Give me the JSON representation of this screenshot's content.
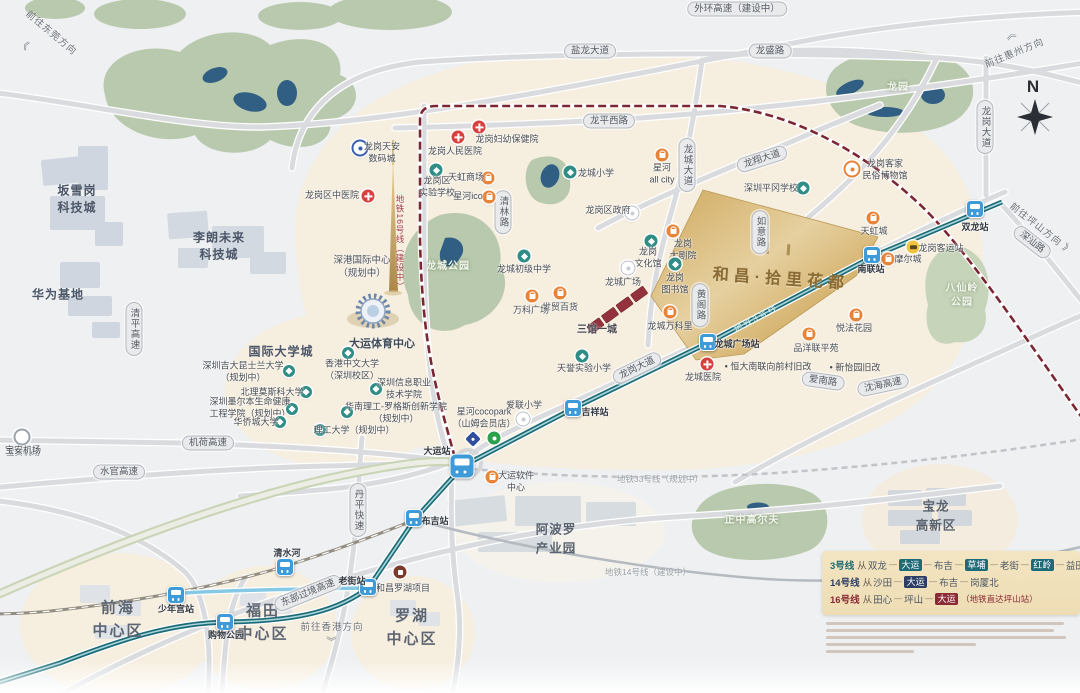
{
  "property": {
    "name": "和昌·拾里花都"
  },
  "compass": {
    "label": "N"
  },
  "colors": {
    "line3": "#1d6b77",
    "line3_core": "#a9d6db",
    "line10": "#86c9e6",
    "line16": "#7a2733",
    "line14": "#b5bac0",
    "line33": "#c0c4c9",
    "road": "#d9dbde",
    "highway_edge": "#c9d4b4",
    "beige": "#f6eedf",
    "park": "#b9c9ad",
    "lake": "#315f83",
    "gold": "#d4b06a",
    "hospital": "#d84040",
    "school": "#2f8d85",
    "shop": "#e8833a",
    "station": "#3f9bd8"
  },
  "legend": {
    "lines": [
      {
        "name": "3号线",
        "color": "#1d6b77",
        "from": "从",
        "start": "双龙",
        "stops": [
          {
            "t": "大运",
            "box": true
          },
          {
            "t": "布吉"
          },
          {
            "t": "草埔",
            "box": true
          },
          {
            "t": "老街"
          },
          {
            "t": "红岭",
            "box": true
          },
          {
            "t": "益田"
          }
        ],
        "suffix": ""
      },
      {
        "name": "14号线",
        "color": "#2c3e66",
        "from": "从",
        "start": "沙田",
        "stops": [
          {
            "t": "大运",
            "box": true
          },
          {
            "t": "布吉"
          },
          {
            "t": "岗厦北"
          }
        ],
        "suffix": ""
      },
      {
        "name": "16号线",
        "color": "#8a2a35",
        "from": "从",
        "start": "田心",
        "stops": [
          {
            "t": "坪山"
          },
          {
            "t": "大运",
            "box": true
          }
        ],
        "suffix": "（地铁直达坪山站）"
      }
    ]
  },
  "capsules": [
    {
      "t": "外环高速（建设中）",
      "x": 737,
      "y": 9
    },
    {
      "t": "盐龙大道",
      "x": 590,
      "y": 51
    },
    {
      "t": "龙盛路",
      "x": 770,
      "y": 51
    },
    {
      "t": "龙平西路",
      "x": 609,
      "y": 121
    },
    {
      "t": "龙翔大道",
      "x": 762,
      "y": 159,
      "rot": -18
    },
    {
      "t": "龙城大道",
      "x": 687,
      "y": 165,
      "vert": true
    },
    {
      "t": "龙岗大道",
      "x": 985,
      "y": 127,
      "vert": true
    },
    {
      "t": "龙岗大道",
      "x": 637,
      "y": 368,
      "rot": -26
    },
    {
      "t": "深汕路",
      "x": 1032,
      "y": 242,
      "rot": 38
    },
    {
      "t": "沈海高速",
      "x": 883,
      "y": 385,
      "rot": -12
    },
    {
      "t": "爱南路",
      "x": 823,
      "y": 381,
      "rot": 8
    },
    {
      "t": "清林路",
      "x": 503,
      "y": 212,
      "vert": true
    },
    {
      "t": "黄阁路",
      "x": 700,
      "y": 305,
      "vert": true
    },
    {
      "t": "如意路",
      "x": 760,
      "y": 232,
      "vert": true
    },
    {
      "t": "清平高速",
      "x": 134,
      "y": 329,
      "vert": true
    },
    {
      "t": "水官高速",
      "x": 119,
      "y": 472
    },
    {
      "t": "机荷高速",
      "x": 208,
      "y": 443
    },
    {
      "t": "丹平快速",
      "x": 358,
      "y": 510,
      "vert": true
    },
    {
      "t": "东部过境高速",
      "x": 308,
      "y": 593,
      "rot": -22
    }
  ],
  "stations": [
    {
      "name": "双龙站",
      "x": 975,
      "y": 209,
      "lx": 975,
      "ly": 228
    },
    {
      "name": "南联站",
      "x": 872,
      "y": 255,
      "lx": 871,
      "ly": 270
    },
    {
      "name": "龙城广场站",
      "x": 708,
      "y": 342,
      "lx": 737,
      "ly": 345
    },
    {
      "name": "吉祥站",
      "x": 573,
      "y": 408,
      "lx": 595,
      "ly": 413
    },
    {
      "name": "大运站",
      "x": 462,
      "y": 466,
      "lx": 437,
      "ly": 452,
      "big": true
    },
    {
      "name": "布吉站",
      "x": 414,
      "y": 518,
      "lx": 435,
      "ly": 522
    },
    {
      "name": "老街站",
      "x": 368,
      "y": 587,
      "lx": 352,
      "ly": 582
    },
    {
      "name": "清水河",
      "x": 285,
      "y": 567,
      "lx": 287,
      "ly": 554
    },
    {
      "name": "少年宫站",
      "x": 176,
      "y": 595,
      "lx": 176,
      "ly": 610
    },
    {
      "name": "购物公园",
      "x": 225,
      "y": 622,
      "lx": 226,
      "ly": 636
    }
  ],
  "pois": [
    {
      "type": "tianan",
      "x": 360,
      "y": 148,
      "label": "龙岗天安\n数码城",
      "lx": 382,
      "ly": 153
    },
    {
      "type": "hospital",
      "x": 368,
      "y": 196,
      "label": "龙岗区中医院",
      "lx": 332,
      "ly": 196
    },
    {
      "type": "hospital",
      "x": 458,
      "y": 137,
      "label": "龙岗人民医院",
      "lx": 455,
      "ly": 152
    },
    {
      "type": "hospital",
      "x": 479,
      "y": 127,
      "label": "龙岗妇幼保健院",
      "lx": 507,
      "ly": 140
    },
    {
      "type": "school",
      "x": 436,
      "y": 170,
      "label": "龙岗区\n实验学校",
      "lx": 437,
      "ly": 187
    },
    {
      "type": "shop",
      "x": 488,
      "y": 178,
      "label": "天虹商场",
      "lx": 466,
      "ly": 178
    },
    {
      "type": "shop",
      "x": 489,
      "y": 197,
      "label": "星河ico",
      "lx": 468,
      "ly": 197
    },
    {
      "type": "school",
      "x": 570,
      "y": 172,
      "label": "龙城小学",
      "lx": 596,
      "ly": 174
    },
    {
      "type": "shop",
      "x": 662,
      "y": 155,
      "label": "星河\nall city",
      "lx": 662,
      "ly": 174
    },
    {
      "type": "gov",
      "x": 632,
      "y": 213,
      "label": "龙岗区政府",
      "lx": 608,
      "ly": 211
    },
    {
      "type": "school",
      "x": 524,
      "y": 256,
      "label": "龙城初级中学",
      "lx": 524,
      "ly": 270
    },
    {
      "type": "theater",
      "x": 673,
      "y": 231,
      "label": "龙岗\n大剧院",
      "lx": 683,
      "ly": 250
    },
    {
      "type": "culture",
      "x": 651,
      "y": 241,
      "label": "龙岗\n文化馆",
      "lx": 648,
      "ly": 258
    },
    {
      "type": "gov",
      "x": 628,
      "y": 268,
      "label": "龙城广场",
      "lx": 623,
      "ly": 283
    },
    {
      "type": "culture",
      "x": 675,
      "y": 264,
      "label": "龙岗\n图书馆",
      "lx": 675,
      "ly": 284
    },
    {
      "type": "museum",
      "x": 852,
      "y": 169,
      "label": "龙岗客家\n民俗博物馆",
      "lx": 885,
      "ly": 170
    },
    {
      "type": "school",
      "x": 803,
      "y": 188,
      "label": "深圳平冈学校",
      "lx": 771,
      "ly": 189
    },
    {
      "type": "shop",
      "x": 560,
      "y": 293,
      "label": "世贸百货",
      "lx": 560,
      "ly": 308
    },
    {
      "type": "shop",
      "x": 532,
      "y": 296,
      "label": "万科广场",
      "lx": 531,
      "ly": 311
    },
    {
      "type": "shop",
      "x": 670,
      "y": 312,
      "label": "龙城万科里",
      "lx": 670,
      "ly": 327
    },
    {
      "type": "school",
      "x": 582,
      "y": 356,
      "label": "天誉实验小学",
      "lx": 584,
      "ly": 369
    },
    {
      "type": "hospital",
      "x": 707,
      "y": 364,
      "label": "龙城医院",
      "lx": 703,
      "ly": 378
    },
    {
      "type": "shop",
      "x": 809,
      "y": 334,
      "label": "品洋联平苑",
      "lx": 816,
      "ly": 349
    },
    {
      "type": "shop",
      "x": 856,
      "y": 315,
      "label": "悦法花园",
      "lx": 854,
      "ly": 329
    },
    {
      "type": "shop",
      "x": 873,
      "y": 218,
      "label": "天虹城",
      "lx": 874,
      "ly": 232
    },
    {
      "type": "shop",
      "x": 888,
      "y": 259,
      "label": "摩尔城",
      "lx": 908,
      "ly": 260
    },
    {
      "type": "bus",
      "x": 913,
      "y": 247,
      "label": "龙岗客运站",
      "lx": 941,
      "ly": 249
    },
    {
      "type": "univ",
      "x": 348,
      "y": 353,
      "label": "香港中文大学\n（深圳校区）",
      "lx": 352,
      "ly": 370
    },
    {
      "type": "univ",
      "x": 289,
      "y": 371,
      "label": "深圳吉大昆士兰大学\n（规划中）",
      "lx": 243,
      "ly": 372
    },
    {
      "type": "univ",
      "x": 306,
      "y": 392,
      "label": "北理莫斯科大学",
      "lx": 272,
      "ly": 393
    },
    {
      "type": "univ",
      "x": 376,
      "y": 389,
      "label": "深圳信息职业\n技术学院",
      "lx": 404,
      "ly": 389
    },
    {
      "type": "univ",
      "x": 292,
      "y": 409,
      "label": "深圳墨尔本生命健康\n工程学院（规划中）",
      "lx": 250,
      "ly": 408
    },
    {
      "type": "univ",
      "x": 347,
      "y": 412,
      "label": "华南理工-罗格斯创新学院\n（规划中）",
      "lx": 396,
      "ly": 413
    },
    {
      "type": "univ",
      "x": 280,
      "y": 422,
      "label": "华侨城大学",
      "lx": 256,
      "ly": 423
    },
    {
      "type": "univ",
      "x": 320,
      "y": 430,
      "label": "理工大学（规划中）",
      "lx": 354,
      "ly": 431
    },
    {
      "type": "gov",
      "x": 523,
      "y": 419,
      "label": "爱联小学",
      "lx": 524,
      "ly": 406
    },
    {
      "type": "mallblue",
      "x": 473,
      "y": 439,
      "label": "星河cocopark\n（山姆会员店）",
      "lx": 484,
      "ly": 418
    },
    {
      "type": "cocogreen",
      "x": 494,
      "y": 438,
      "label": "",
      "lx": 494,
      "ly": 438
    },
    {
      "type": "shop",
      "x": 492,
      "y": 477,
      "label": "大运软件\n中心",
      "lx": 516,
      "ly": 482
    },
    {
      "type": "brand",
      "x": 400,
      "y": 572,
      "label": "和昌罗湖项目",
      "lx": 403,
      "ly": 589
    },
    {
      "type": "ringgray",
      "x": 22,
      "y": 437,
      "label": "宝安机场",
      "lx": 23,
      "ly": 451
    }
  ],
  "texts": [
    {
      "t": "坂雪岗\n科技城",
      "x": 77,
      "y": 200,
      "cls": "district"
    },
    {
      "t": "华为基地",
      "x": 58,
      "y": 295,
      "cls": "district"
    },
    {
      "t": "李朗未来\n科技城",
      "x": 219,
      "y": 247,
      "cls": "district"
    },
    {
      "t": "国际大学城",
      "x": 281,
      "y": 352,
      "cls": "district"
    },
    {
      "t": "前海\n中心区",
      "x": 118,
      "y": 620,
      "cls": "district-lg"
    },
    {
      "t": "福田\n中心区",
      "x": 263,
      "y": 623,
      "cls": "district-lg"
    },
    {
      "t": "罗湖\n中心区",
      "x": 412,
      "y": 628,
      "cls": "district-lg"
    },
    {
      "t": "阿波罗\n产业园",
      "x": 556,
      "y": 539,
      "cls": "district-md"
    },
    {
      "t": "宝龙\n高新区",
      "x": 936,
      "y": 516,
      "cls": "district-md"
    },
    {
      "t": "龙城公园",
      "x": 448,
      "y": 267,
      "cls": "park"
    },
    {
      "t": "龙园",
      "x": 898,
      "y": 88,
      "cls": "park"
    },
    {
      "t": "八仙岭\n公园",
      "x": 962,
      "y": 296,
      "cls": "park"
    },
    {
      "t": "正中高尔夫",
      "x": 752,
      "y": 521,
      "cls": "park"
    },
    {
      "t": "深港国际中心\n（规划中）",
      "x": 362,
      "y": 268,
      "cls": "poi-dark"
    },
    {
      "t": "大运体育中心",
      "x": 382,
      "y": 343,
      "cls": "bold-dark"
    },
    {
      "t": "三馆一城",
      "x": 597,
      "y": 328,
      "cls": "bold-dark2"
    },
    {
      "t": "地铁16号线（建设中）",
      "x": 400,
      "y": 243,
      "cls": "metro-red-vert"
    },
    {
      "t": "地铁3号线",
      "x": 756,
      "y": 318,
      "cls": "metro-teal",
      "rot": -28
    },
    {
      "t": "地铁33号线（规划中）",
      "x": 660,
      "y": 479,
      "cls": "metro-gray"
    },
    {
      "t": "地铁14号线（建设中）",
      "x": 648,
      "y": 572,
      "cls": "metro-gray"
    },
    {
      "t": "• 恒大南联向前村旧改",
      "x": 768,
      "y": 366,
      "cls": "bullet"
    },
    {
      "t": "• 新怡园旧改",
      "x": 855,
      "y": 367,
      "cls": "bullet"
    },
    {
      "t": "前往惠州方向",
      "x": 1014,
      "y": 52,
      "cls": "dir",
      "rot": -22
    },
    {
      "t": "《",
      "x": 1011,
      "y": 34,
      "cls": "dir-arrow",
      "rot": 65
    },
    {
      "t": "前往坪山方向 》",
      "x": 1042,
      "y": 228,
      "cls": "dir",
      "rot": 38
    },
    {
      "t": "前往东莞方向",
      "x": 52,
      "y": 32,
      "cls": "dir",
      "rot": 40
    },
    {
      "t": "《",
      "x": 24,
      "y": 44,
      "cls": "dir-arrow",
      "rot": 25
    },
    {
      "t": "前往香港方向",
      "x": 332,
      "y": 626,
      "cls": "dir"
    },
    {
      "t": "》",
      "x": 332,
      "y": 641,
      "cls": "dir-arrow",
      "rot": 90
    },
    {
      "t": "宝安机场",
      "x": 23,
      "y": 452,
      "cls": "tiny-gray"
    }
  ]
}
